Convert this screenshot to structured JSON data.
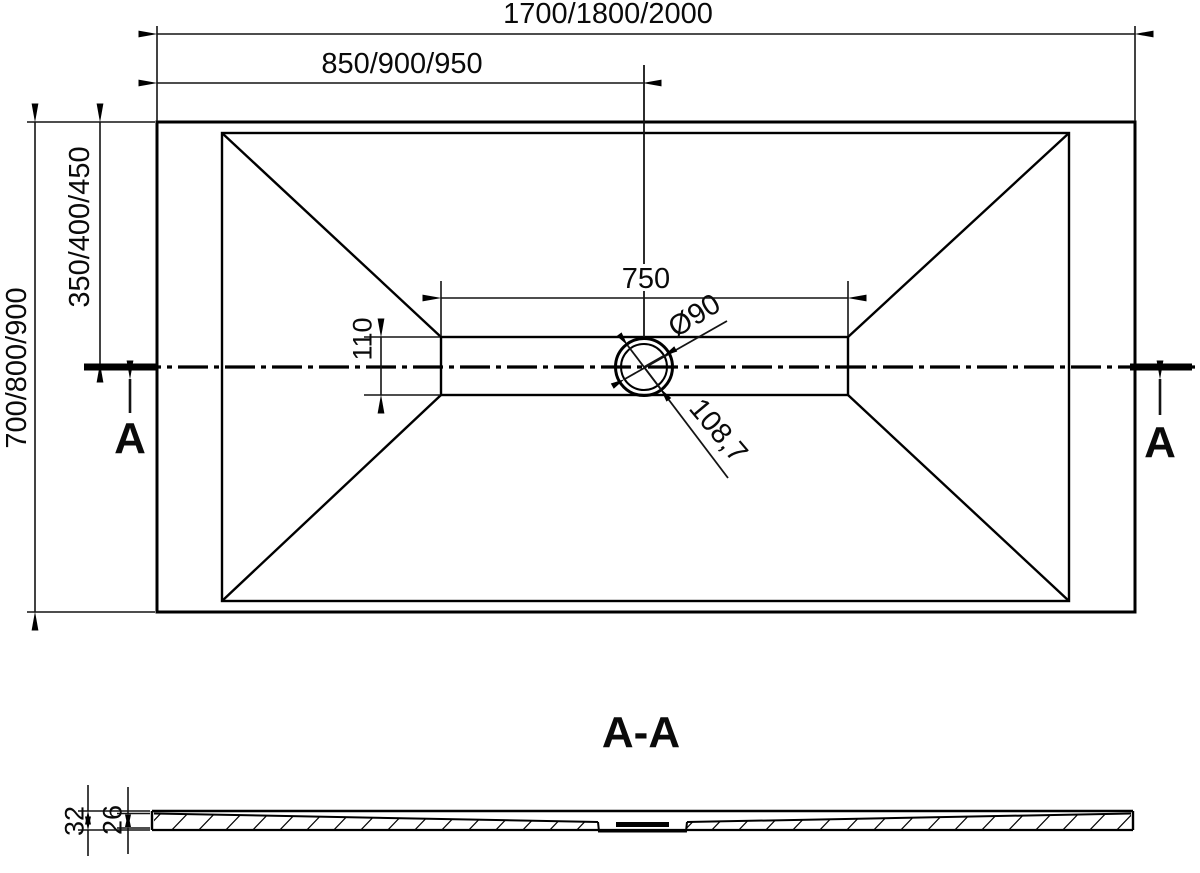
{
  "drawing": {
    "type": "technical-drawing",
    "subject": "rectangular shower tray with central linear drain, plan view and A-A cross-section",
    "colors": {
      "background": "#ffffff",
      "line": "#000000"
    },
    "plan_view": {
      "dimensions": {
        "total_width": "1700/1800/2000",
        "center_offset_width": "850/900/950",
        "total_depth": "700/800/900",
        "center_offset_depth": "350/400/450",
        "channel_length": "750",
        "channel_width": "110",
        "drain_diameter": "Ø90",
        "drain_outer_diameter": "108,7"
      },
      "section_cut": {
        "marker_left": "A",
        "marker_right": "A"
      }
    },
    "section_view": {
      "label": "A-A",
      "dimensions": {
        "total_height": "32",
        "inner_height": "26"
      }
    }
  }
}
